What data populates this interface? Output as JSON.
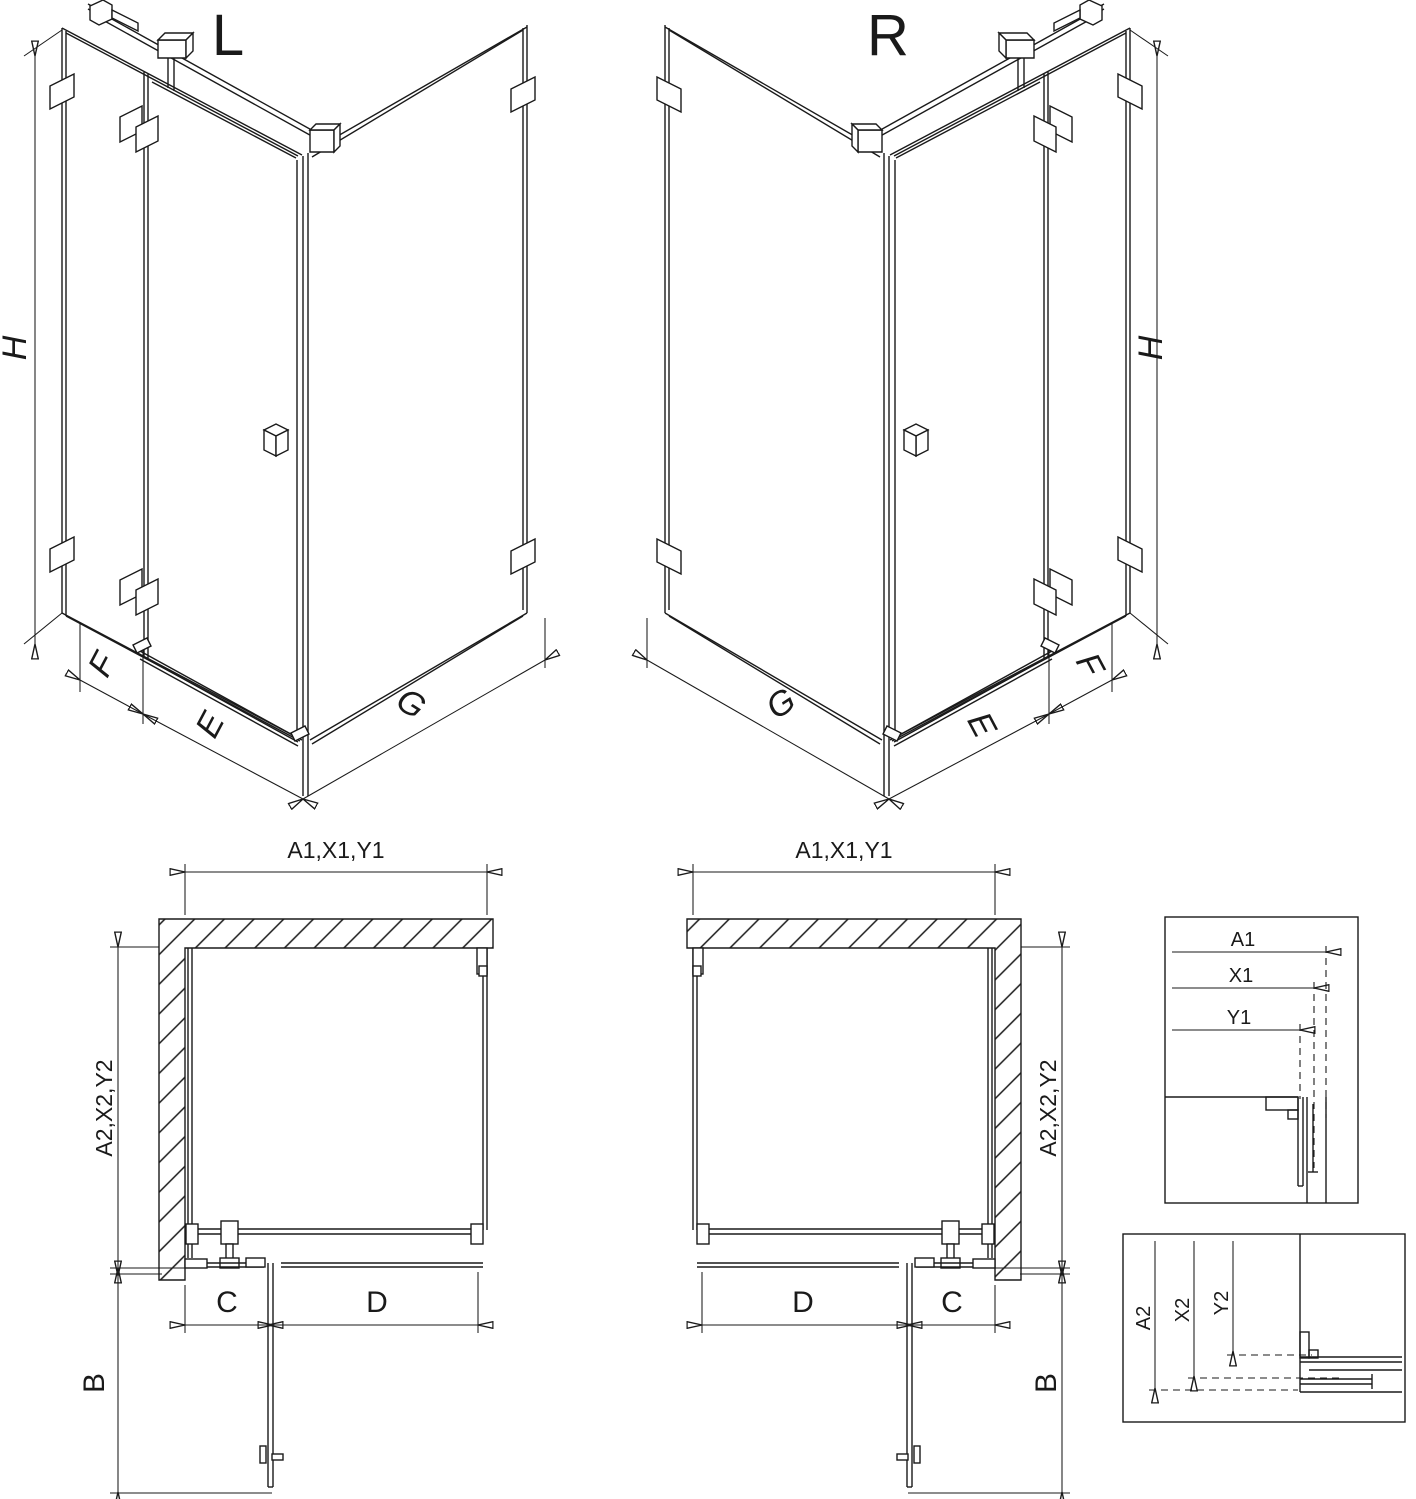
{
  "diagram_title": "shower-enclosure-dimension-diagram",
  "colors": {
    "line": "#1a1a1a",
    "background": "#ffffff"
  },
  "iso_left": {
    "label": "L",
    "dim_height": "H",
    "dim_fixed_panel": "F",
    "dim_door": "E",
    "dim_side_wall": "G"
  },
  "iso_right": {
    "label": "R",
    "dim_height": "H",
    "dim_fixed_panel": "F",
    "dim_door": "E",
    "dim_side_wall": "G"
  },
  "plan_left": {
    "dim_width_top": "A1,X1,Y1",
    "dim_depth_side": "A2,X2,Y2",
    "dim_c": "C",
    "dim_d": "D",
    "dim_b": "B"
  },
  "plan_right": {
    "dim_width_top": "A1,X1,Y1",
    "dim_depth_side": "A2,X2,Y2",
    "dim_c": "C",
    "dim_d": "D",
    "dim_b": "B"
  },
  "detail_width": {
    "a1": "A1",
    "x1": "X1",
    "y1": "Y1"
  },
  "detail_depth": {
    "a2": "A2",
    "x2": "X2",
    "y2": "Y2"
  }
}
